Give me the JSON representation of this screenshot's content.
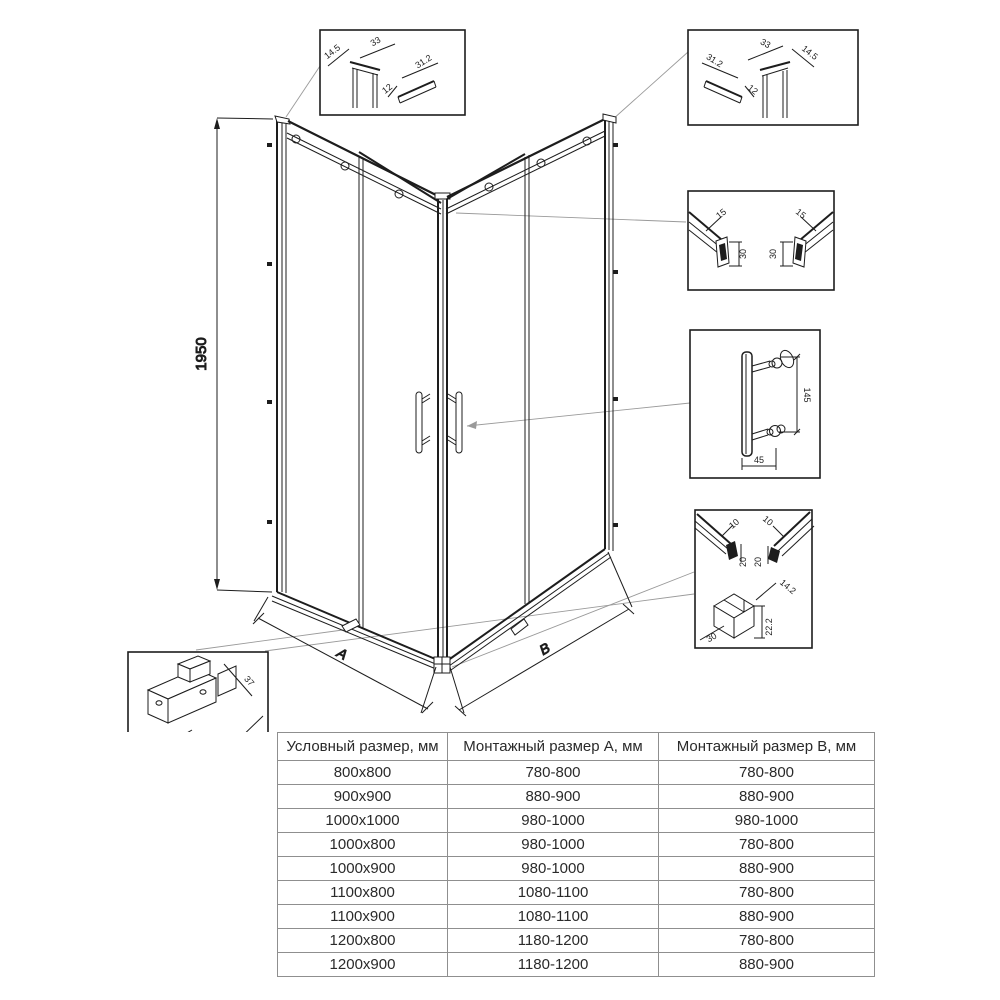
{
  "drawing": {
    "height_dim": "1950",
    "dim_a": "A",
    "dim_b": "B"
  },
  "callouts": {
    "top_left": {
      "d14_5": "14.5",
      "d33": "33",
      "d12": "12",
      "d31_2": "31.2"
    },
    "top_right": {
      "d31_2": "31.2",
      "d12": "12",
      "d33": "33",
      "d14_5": "14.5"
    },
    "rails": {
      "left_15": "15",
      "left_30": "30",
      "right_15": "15",
      "right_30": "30"
    },
    "handle": {
      "d145": "145",
      "d45": "45"
    },
    "bottom_right": {
      "left_10": "10",
      "right_10": "10",
      "left_20": "20",
      "right_20": "20",
      "d14_2": "14.2",
      "d22_2": "22.2",
      "d30": "30"
    },
    "roller": {
      "d55": "55",
      "d37": "37",
      "d59": "59"
    }
  },
  "table": {
    "headers": [
      "Условный размер, мм",
      "Монтажный размер А, мм",
      "Монтажный размер В, мм"
    ],
    "rows": [
      [
        "800x800",
        "780-800",
        "780-800"
      ],
      [
        "900x900",
        "880-900",
        "880-900"
      ],
      [
        "1000x1000",
        "980-1000",
        "980-1000"
      ],
      [
        "1000x800",
        "980-1000",
        "780-800"
      ],
      [
        "1000x900",
        "980-1000",
        "880-900"
      ],
      [
        "1100x800",
        "1080-1100",
        "780-800"
      ],
      [
        "1100x900",
        "1080-1100",
        "880-900"
      ],
      [
        "1200x800",
        "1180-1200",
        "780-800"
      ],
      [
        "1200x900",
        "1180-1200",
        "880-900"
      ]
    ]
  }
}
